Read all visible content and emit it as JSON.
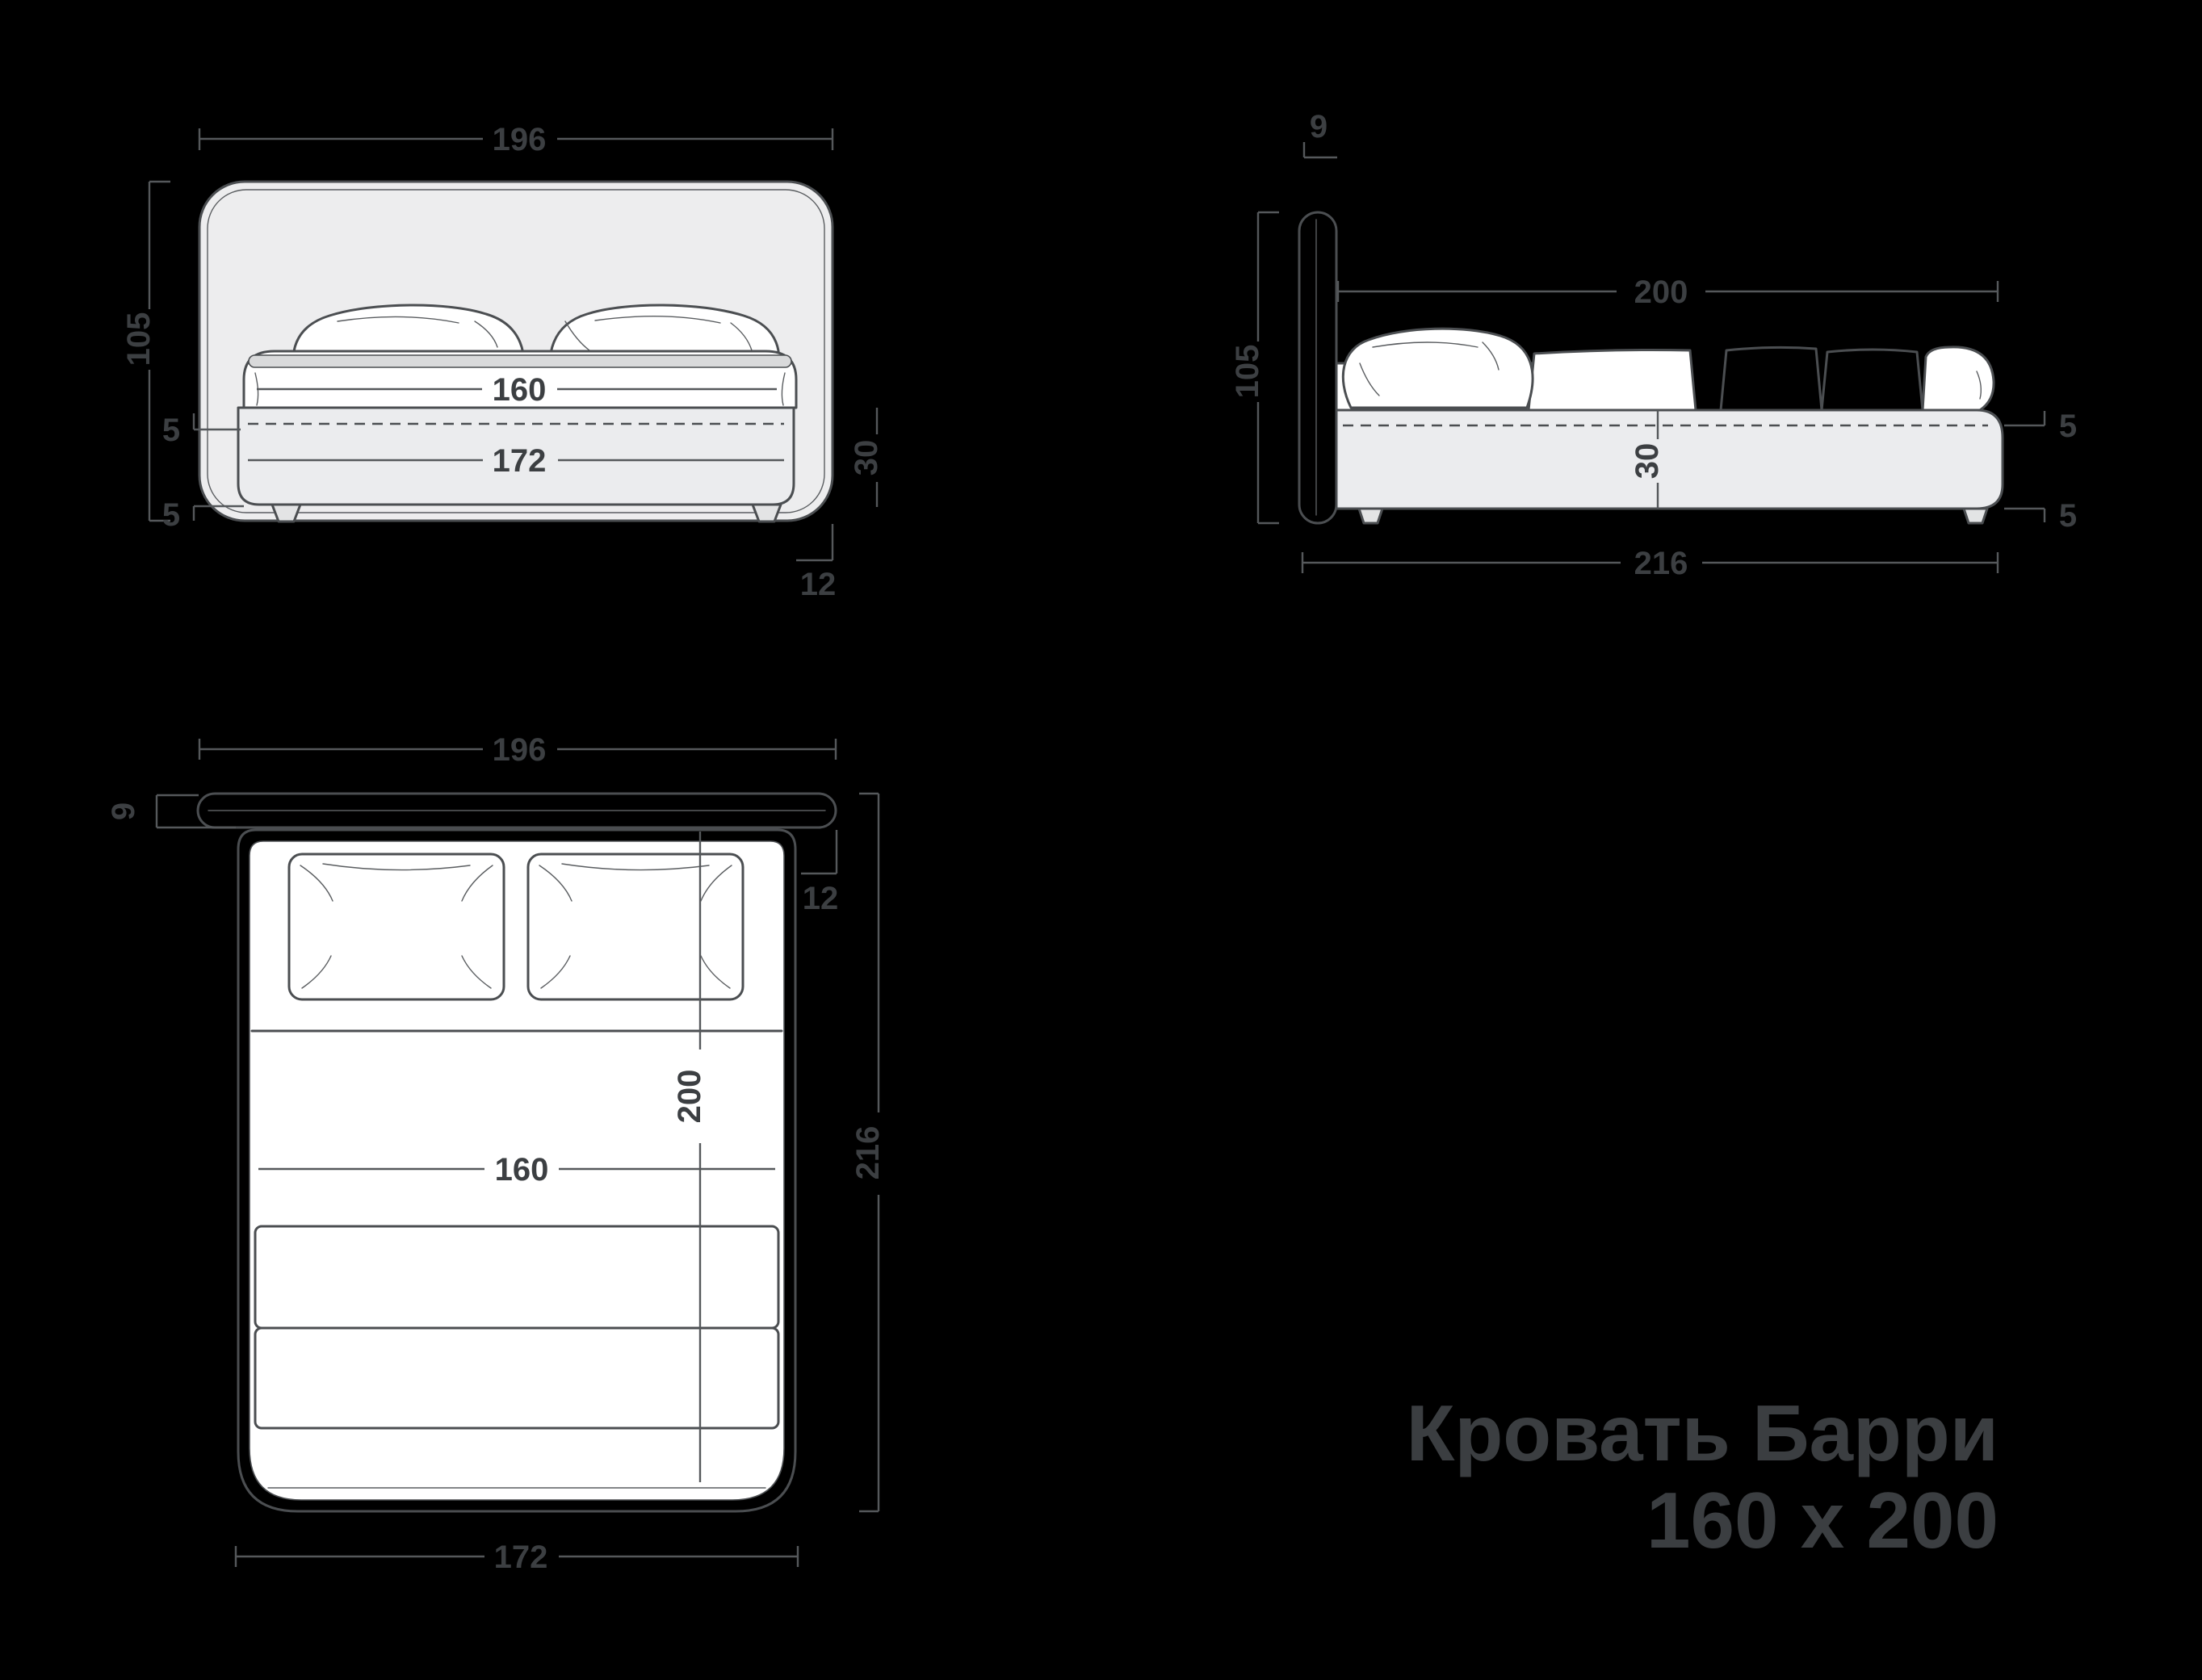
{
  "title": {
    "line1": "Кровать Барри",
    "line2": "160 x 200"
  },
  "dims": {
    "front": {
      "overall_width": "196",
      "overall_height": "105",
      "mattress_width": "160",
      "frame_width": "172",
      "rail_lip": "5",
      "leg_height": "5",
      "frame_height": "30",
      "headboard_overhang": "12"
    },
    "side": {
      "headboard_thickness": "9",
      "mattress_length": "200",
      "overall_height": "105",
      "frame_height": "30",
      "rail_lip": "5",
      "leg_height": "5",
      "overall_length": "216"
    },
    "top": {
      "overall_width": "196",
      "headboard_thickness": "9",
      "headboard_overhang": "12",
      "mattress_length": "200",
      "mattress_width": "160",
      "overall_length": "216",
      "frame_width": "172"
    }
  },
  "colors": {
    "background": "#000000",
    "outline": "#4b4e51",
    "dimension_line": "#55585b",
    "dimension_text": "#3c3f42",
    "title_text": "#3b3e41",
    "panel_fill": "#ededee",
    "white_fill": "#ffffff",
    "blanket_gray_1": "#d3d4d6",
    "blanket_gray_2": "#c9cacc"
  }
}
